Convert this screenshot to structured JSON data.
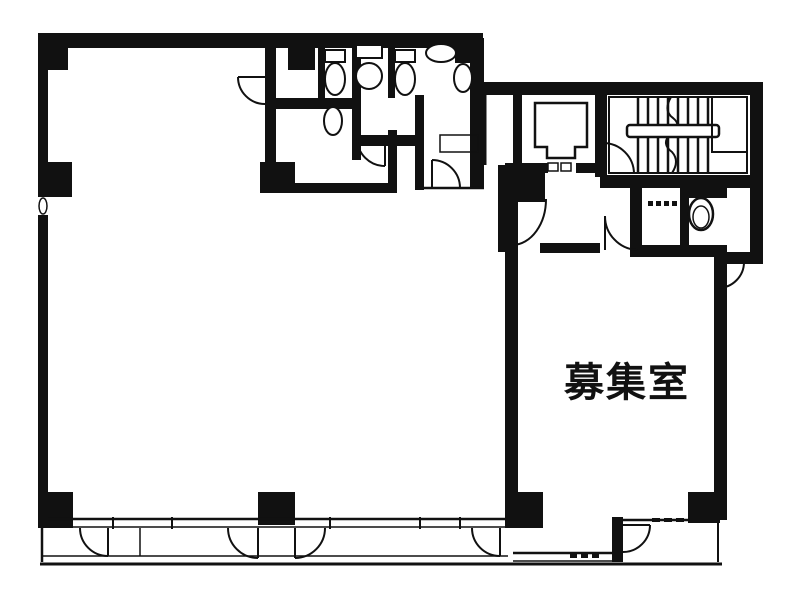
{
  "canvas": {
    "width": 787,
    "height": 611,
    "background_color": "#ffffff",
    "ink_color": "#111111"
  },
  "floorplan": {
    "room_label": "募集室",
    "fixtures": {
      "toilet_icon_count": 5,
      "basin_icon_count": 2,
      "has_elevator": true,
      "has_staircase": true,
      "has_balcony": true,
      "door_arc_count": 12,
      "column_count": 8
    }
  }
}
